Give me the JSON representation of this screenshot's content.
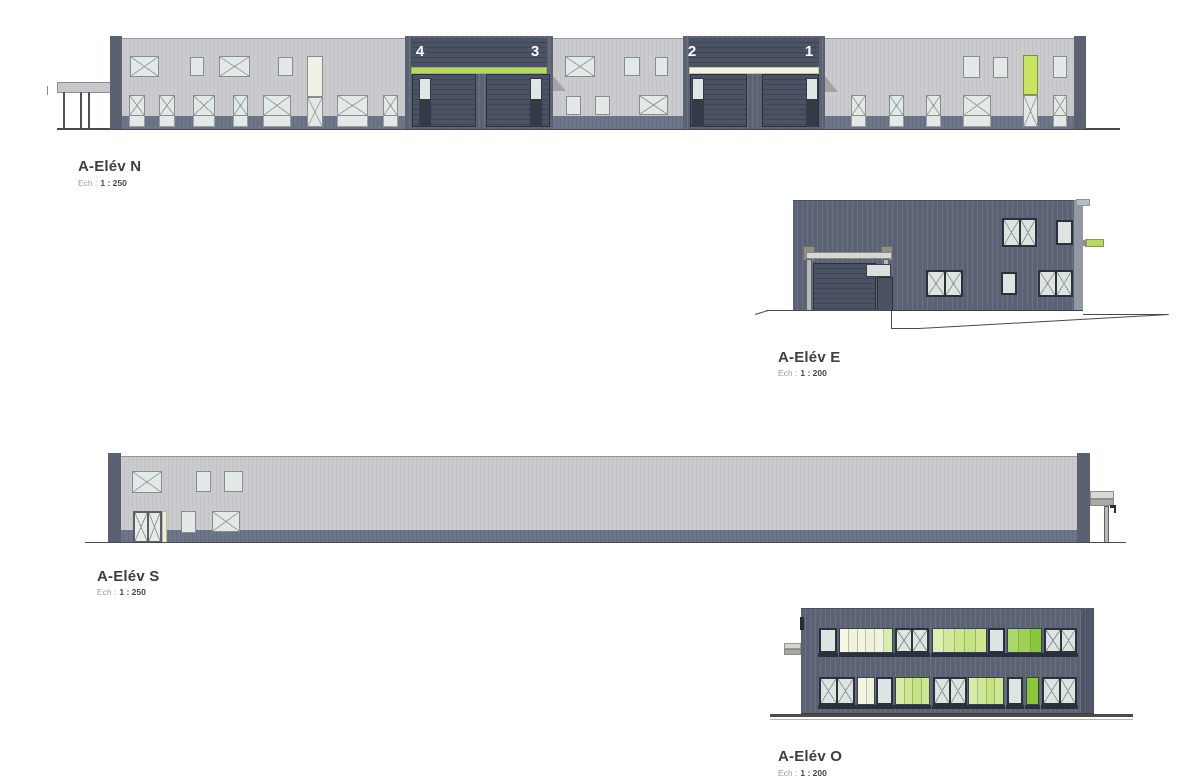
{
  "elevations": {
    "north": {
      "label": "A-Elév N",
      "scale_prefix": "Ech :",
      "scale_value": "1 : 250",
      "bays": [
        "4",
        "3",
        "2",
        "1"
      ]
    },
    "east": {
      "label": "A-Elév E",
      "scale_prefix": "Ech :",
      "scale_value": "1 : 200"
    },
    "south": {
      "label": "A-Elév S",
      "scale_prefix": "Ech :",
      "scale_value": "1 : 250"
    },
    "west": {
      "label": "A-Elév O",
      "scale_prefix": "Ech :",
      "scale_value": "1 : 200"
    }
  },
  "colors": {
    "facade_light": "#c9c9cd",
    "facade_dark": "#5c6375",
    "base_strip": "#6d7588",
    "accent_green": "#b6da5f",
    "accent_green_bright": "#8bc838",
    "accent_cream": "#f1f4de",
    "door_green": "#c9e45e",
    "glass": "#e2e9e7"
  }
}
